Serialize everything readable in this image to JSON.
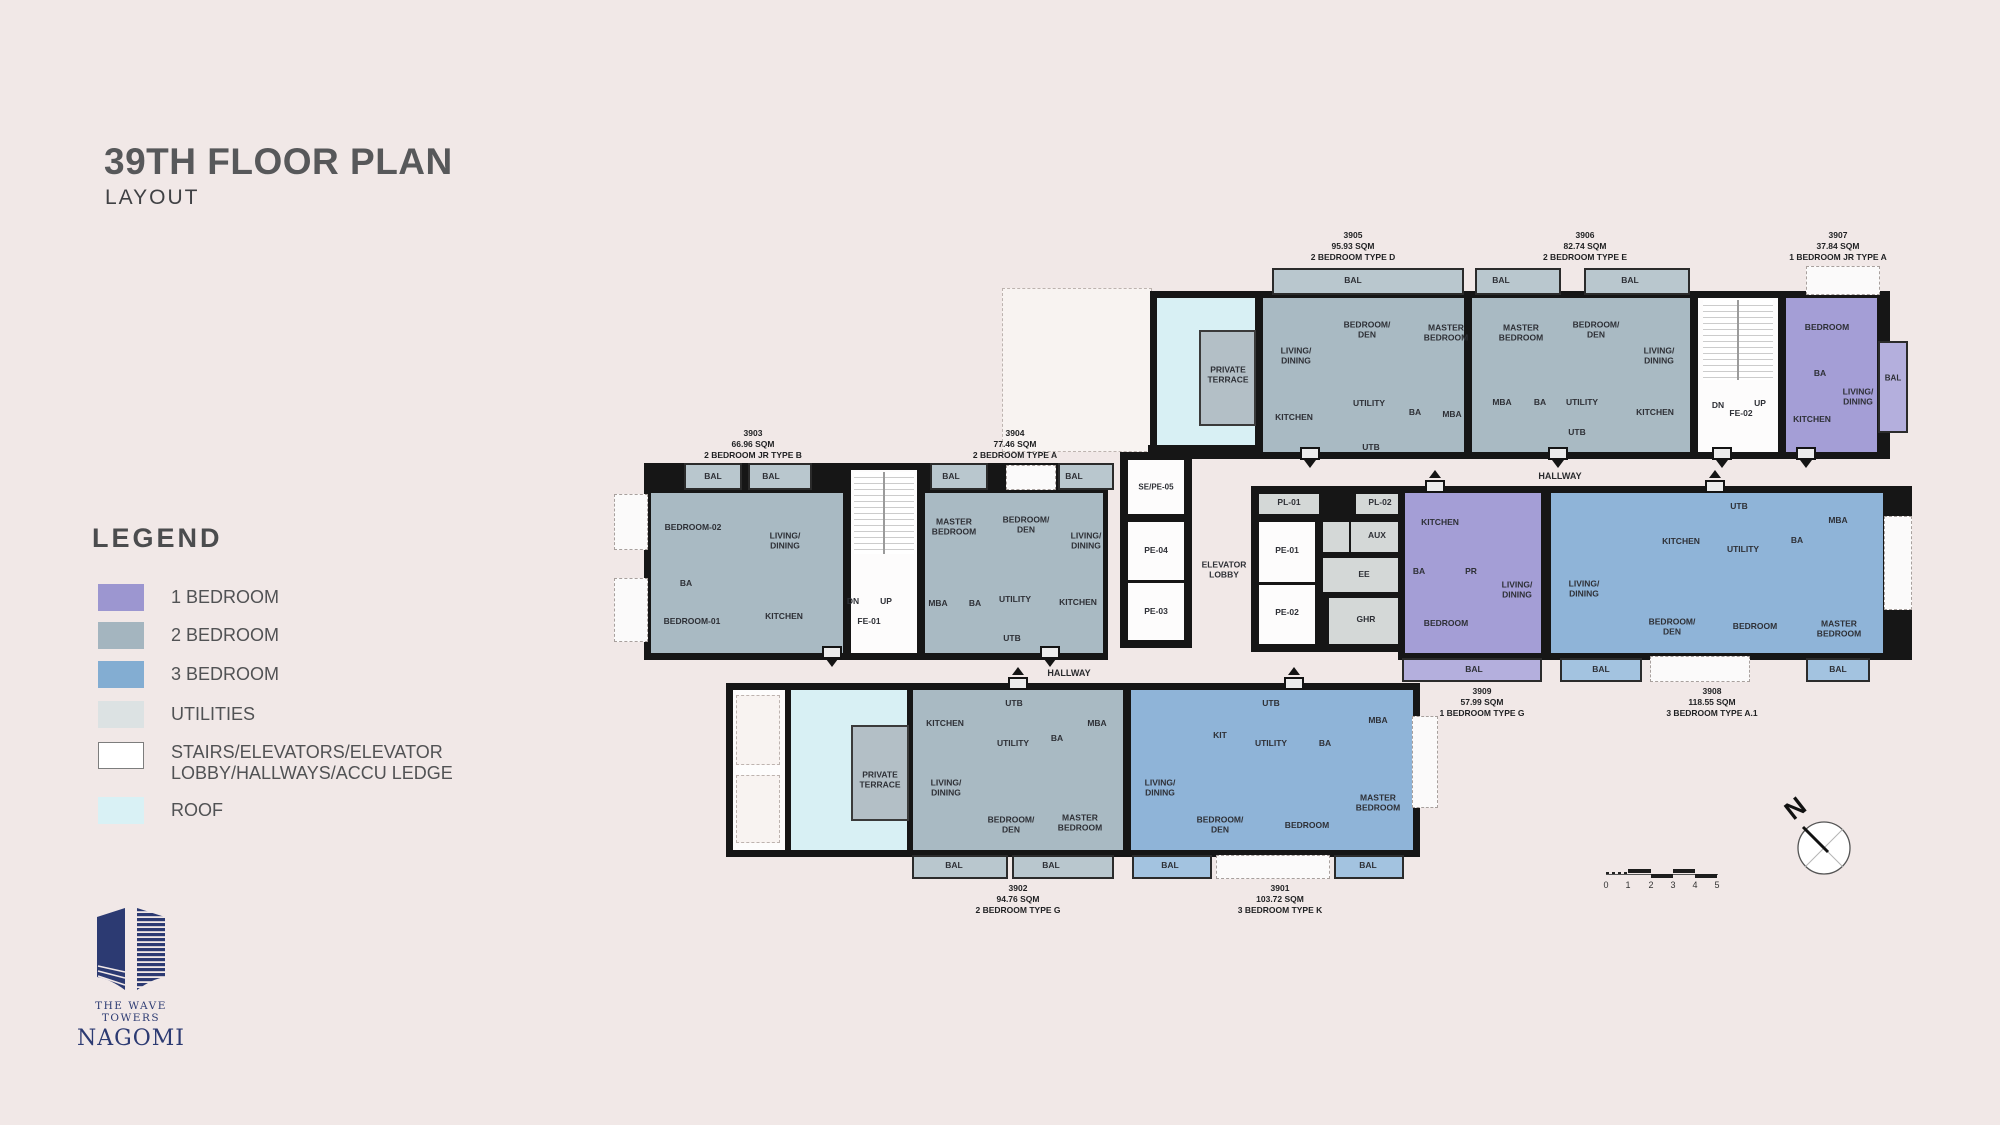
{
  "header": {
    "title": "39TH FLOOR PLAN",
    "subtitle": "LAYOUT"
  },
  "legend": {
    "title": "LEGEND",
    "items": [
      {
        "label": "1 BEDROOM",
        "color": "#9c96d0"
      },
      {
        "label": "2 BEDROOM",
        "color": "#a4b5bf"
      },
      {
        "label": "3 BEDROOM",
        "color": "#83add2"
      },
      {
        "label": "UTILITIES",
        "color": "#dce2e3"
      },
      {
        "label": "STAIRS/ELEVATORS/ELEVATOR\nLOBBY/HALLWAYS/ACCU LEDGE",
        "color": "#ffffff"
      },
      {
        "label": "ROOF",
        "color": "#d9f1f5"
      }
    ]
  },
  "units": [
    {
      "num": "3901",
      "area": "103.72 SQM",
      "type": "3 BEDROOM TYPE K",
      "rooms": [
        "LIVING/\nDINING",
        "KIT",
        "UTB",
        "UTILITY",
        "BA",
        "MBA",
        "BEDROOM/\nDEN",
        "BEDROOM",
        "MASTER\nBEDROOM",
        "BAL",
        "BAL"
      ]
    },
    {
      "num": "3902",
      "area": "94.76 SQM",
      "type": "2 BEDROOM TYPE G",
      "rooms": [
        "PRIVATE\nTERRACE",
        "KITCHEN",
        "UTB",
        "UTILITY",
        "BA",
        "MBA",
        "LIVING/\nDINING",
        "BEDROOM/\nDEN",
        "MASTER\nBEDROOM",
        "BAL",
        "BAL"
      ]
    },
    {
      "num": "3903",
      "area": "66.96 SQM",
      "type": "2 BEDROOM JR TYPE B",
      "rooms": [
        "BAL",
        "BAL",
        "BEDROOM-02",
        "LIVING/\nDINING",
        "BA",
        "BEDROOM-01",
        "KITCHEN"
      ]
    },
    {
      "num": "3904",
      "area": "77.46 SQM",
      "type": "2 BEDROOM TYPE A",
      "rooms": [
        "BAL",
        "BAL",
        "MASTER\nBEDROOM",
        "BEDROOM/\nDEN",
        "LIVING/\nDINING",
        "MBA",
        "BA",
        "UTILITY",
        "KITCHEN",
        "UTB"
      ]
    },
    {
      "num": "3905",
      "area": "95.93 SQM",
      "type": "2 BEDROOM TYPE D",
      "rooms": [
        "PRIVATE\nTERRACE",
        "BAL",
        "LIVING/\nDINING",
        "BEDROOM/\nDEN",
        "MASTER\nBEDROOM",
        "KITCHEN",
        "UTILITY",
        "BA",
        "MBA",
        "UTB"
      ]
    },
    {
      "num": "3906",
      "area": "82.74 SQM",
      "type": "2 BEDROOM TYPE E",
      "rooms": [
        "BAL",
        "BAL",
        "MASTER\nBEDROOM",
        "BEDROOM/\nDEN",
        "LIVING/\nDINING",
        "MBA",
        "BA",
        "UTILITY",
        "UTB",
        "KITCHEN"
      ]
    },
    {
      "num": "3907",
      "area": "37.84 SQM",
      "type": "1 BEDROOM JR TYPE A",
      "rooms": [
        "BEDROOM",
        "BA",
        "LIVING/\nDINING",
        "KITCHEN",
        "BAL"
      ]
    },
    {
      "num": "3908",
      "area": "118.55 SQM",
      "type": "3 BEDROOM TYPE A.1",
      "rooms": [
        "LIVING/\nDINING",
        "KITCHEN",
        "UTB",
        "UTILITY",
        "BA",
        "MBA",
        "BEDROOM/\nDEN",
        "BEDROOM",
        "MASTER\nBEDROOM",
        "BAL",
        "BAL"
      ]
    },
    {
      "num": "3909",
      "area": "57.99 SQM",
      "type": "1 BEDROOM TYPE G",
      "rooms": [
        "KITCHEN",
        "BA",
        "PR",
        "LIVING/\nDINING",
        "BEDROOM",
        "BAL"
      ]
    }
  ],
  "core": {
    "se_pe_05": "SE/PE-05",
    "pe_04": "PE-04",
    "pe_03": "PE-03",
    "lobby": "ELEVATOR\nLOBBY",
    "pe_01": "PE-01",
    "pe_02": "PE-02",
    "pl_01": "PL-01",
    "pl_02": "PL-02",
    "aux": "AUX",
    "ee": "EE",
    "ghr": "GHR",
    "fe_01": "FE-01",
    "fe_02": "FE-02",
    "dn": "DN",
    "up": "UP"
  },
  "plan": {
    "hallways": [
      "HALLWAY",
      "HALLWAY"
    ]
  },
  "compass": {
    "north": "N"
  },
  "scale": {
    "ticks": [
      "0",
      "1",
      "2",
      "3",
      "4",
      "5"
    ]
  },
  "logo": {
    "line1": "THE WAVE TOWERS",
    "line2": "NAGOMI"
  }
}
